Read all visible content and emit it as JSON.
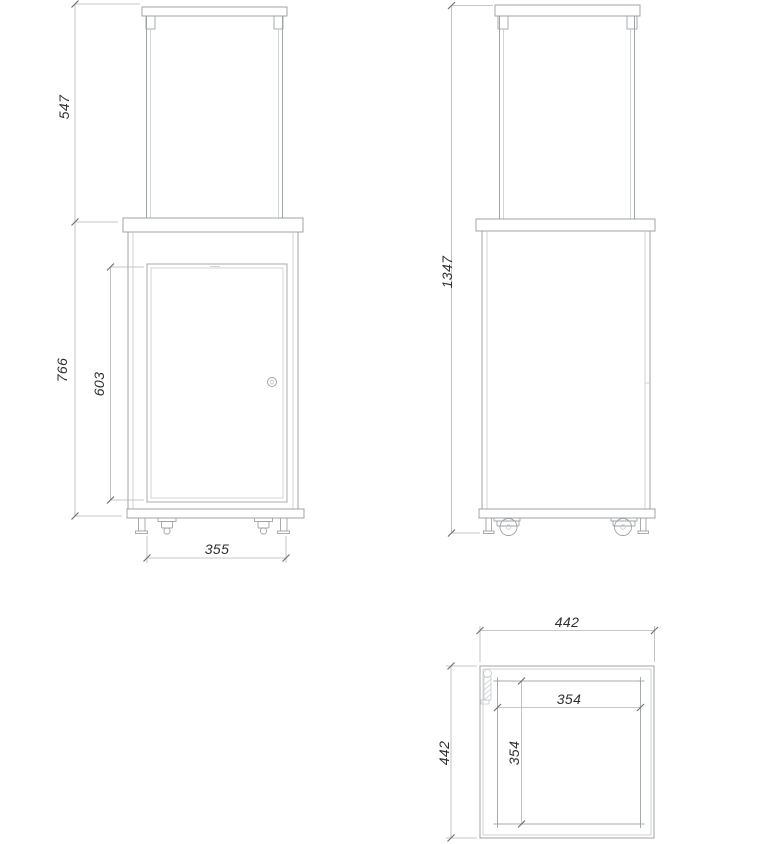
{
  "colors": {
    "background": "#ffffff",
    "line_main": "#9fa3a5",
    "line_light": "#c6c9ca",
    "line_dim": "#b2b5b7",
    "tick": "#6f7375",
    "text": "#2e3032"
  },
  "views": {
    "front": {
      "dimensions": {
        "glass_height": "547",
        "body_height": "766",
        "door_height": "603",
        "feet_spacing": "355"
      }
    },
    "side": {
      "dimensions": {
        "total_height": "1347"
      }
    },
    "top": {
      "dimensions": {
        "outer_width": "442",
        "outer_depth": "442",
        "inner_width": "354",
        "inner_depth": "354"
      }
    }
  }
}
